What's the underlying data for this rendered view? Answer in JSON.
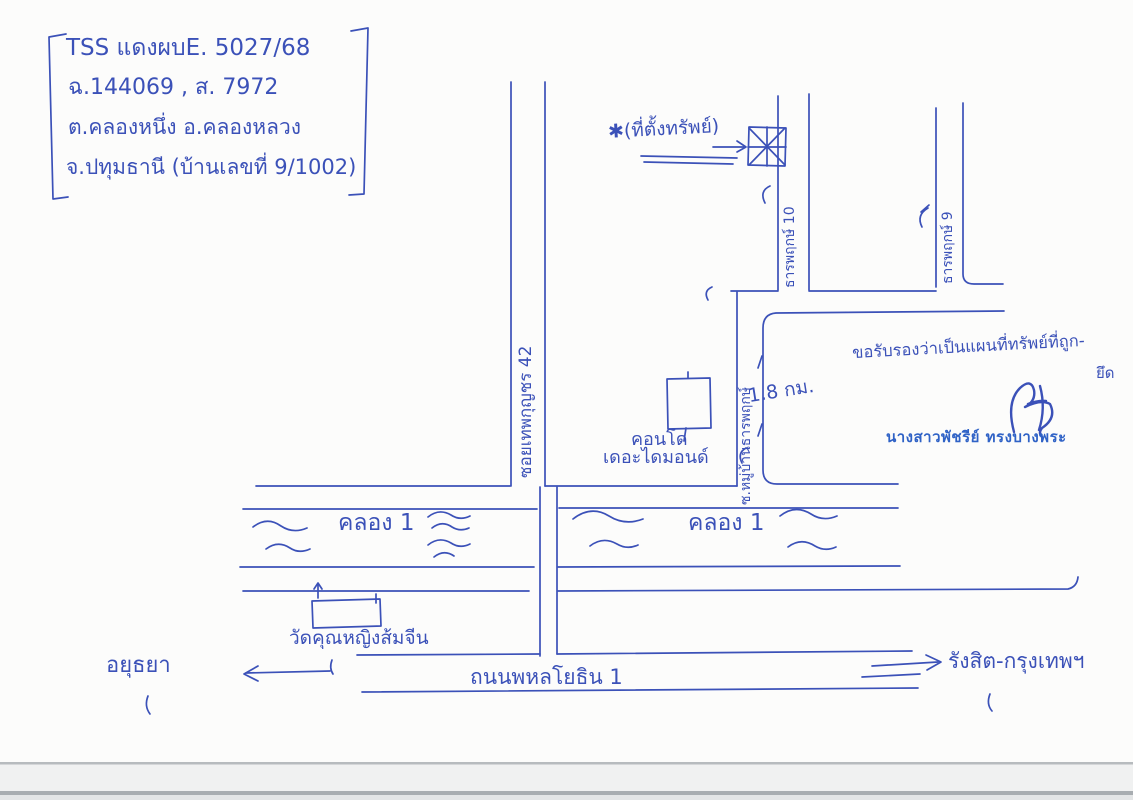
{
  "page": {
    "background": "#fcfcfb",
    "ink_color": "#3b51b8",
    "stamp_color": "#2f62c6",
    "description": "hand-drawn property location map, blue pen on white scanned paper"
  },
  "case_block": {
    "line1": "TSS แดงผบE. 5027/68",
    "line2": "ฉ.144069 , ส. 7972",
    "line3": "ต.คลองหนึ่ง อ.คลองหลวง",
    "line4": "จ.ปทุมธานี (บ้านเลขที่ 9/1002)"
  },
  "property_marker": {
    "label": "✱(ที่ตั้งทรัพย์)",
    "symbol": "square-with-asterisk-cross"
  },
  "road_labels": {
    "soi_thep_kunchon_42": "ซอยเทพกุญชร 42",
    "soi_than_phruek_10": "ธารพฤกษ์ 10",
    "soi_than_phruek_9": "ธารพฤกษ์ 9",
    "soi_muban_than_phruek": "ซ.หมู่บ้านธารพฤกษ์",
    "phahonyothin": "ถนนพหลโยธิน 1"
  },
  "canal_labels": {
    "left": "คลอง 1",
    "right": "คลอง 1"
  },
  "landmarks": {
    "condo": {
      "line1": "คอนโด",
      "line2": "เดอะไดมอนด์"
    },
    "temple": "วัดคุณหญิงส้มจีน",
    "distance_note": "1.8 กม."
  },
  "directions": {
    "west": "อยุธยา",
    "east": "รังสิต-กรุงเทพฯ"
  },
  "certification": {
    "line1": "ขอรับรองว่าเป็นแผนที่ทรัพย์ที่ถูก-",
    "line2": "ยึด",
    "certifier_name": "นางสาวพัชรีย์ ทรงบางพระ"
  }
}
